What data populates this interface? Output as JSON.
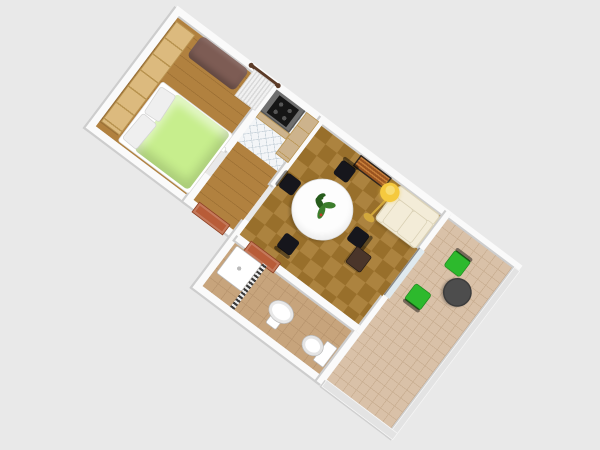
{
  "scene": {
    "type": "3d-rendered-apartment-floor-plan",
    "view": "aerial-oblique",
    "rotation_deg": 37
  },
  "colors": {
    "background": "#e9e9e9",
    "wall": "#fafafa",
    "wall-edge": "#cdcdcd",
    "wood-floor": "#b1813f",
    "wood-line": "#9c6f33",
    "parquet-floor": "#a5782f",
    "tile-floor": "#f3f5f7",
    "tile-line": "#c9d4db",
    "bath-floor": "#c7a47c",
    "bath-line": "#b8956e",
    "balcony-floor": "#d9c1a8",
    "balcony-line": "#c8ad90",
    "bed-spread": "#c7ee8d",
    "pillow": "#efefef",
    "bed-base": "#ffffff",
    "wardrobe": "#dcba7e",
    "wardrobe-line": "#b8934f",
    "daybed": "#7d5c54",
    "curtain": "#f1f1f1",
    "curtain-line": "#d9d9d9",
    "curtain-rod": "#5b3a26",
    "counter": "#6f6f6f",
    "cabinet": "#cdb38c",
    "stove": "#161616",
    "radiator": "#9a5420",
    "radiator-fin": "#c87f3a",
    "radiator-frame": "#2f241c",
    "table-top": "#fdfdfd",
    "table-edge": "#d8d8d8",
    "chair-black": "#16161c",
    "plant-leaf": "#3c7d2c",
    "plant-leaf-dark": "#275c1c",
    "plant-flower": "#ffffff",
    "plant-berry": "#c23b2a",
    "sofa": "#f3ecd8",
    "sofa-edge": "#d9d0b4",
    "lamp-shade": "#f5c93e",
    "lamp-highlight": "#f8dc72",
    "lamp-base": "#d2a83c",
    "stool": "#4a352a",
    "door": "#b85c38",
    "door-dark": "#8a4226",
    "glass": "#dfe9ee",
    "railing": "#e3e3e3",
    "fixture": "#ffffff",
    "fixture-edge": "#b9b9b9",
    "terrace-chair": "#2db92d",
    "terrace-chair-dark": "#1f8c1f",
    "terrace-table": "#4d4d4d"
  },
  "rooms": [
    {
      "name": "bedroom",
      "furniture": [
        "wardrobe",
        "daybed",
        "double-bed",
        "pillows",
        "window-curtain"
      ]
    },
    {
      "name": "kitchen",
      "furniture": [
        "counter",
        "stove",
        "tall-cabinet"
      ]
    },
    {
      "name": "hallway",
      "furniture": [
        "bedroom-door",
        "entrance-door"
      ]
    },
    {
      "name": "living-room",
      "furniture": [
        "radiator",
        "round-dining-table",
        "potted-plant",
        "dining-chair-north",
        "dining-chair-west",
        "dining-chair-south",
        "dining-chair-east",
        "sofa",
        "floor-lamp",
        "side-chair",
        "balcony-glass-door"
      ]
    },
    {
      "name": "bathroom",
      "furniture": [
        "shower-tray",
        "shower-curtain",
        "pedestal-sink",
        "toilet",
        "bathroom-door"
      ]
    },
    {
      "name": "balcony",
      "furniture": [
        "terrace-chair-1",
        "terrace-chair-2",
        "terrace-table",
        "glass-railing"
      ]
    }
  ]
}
